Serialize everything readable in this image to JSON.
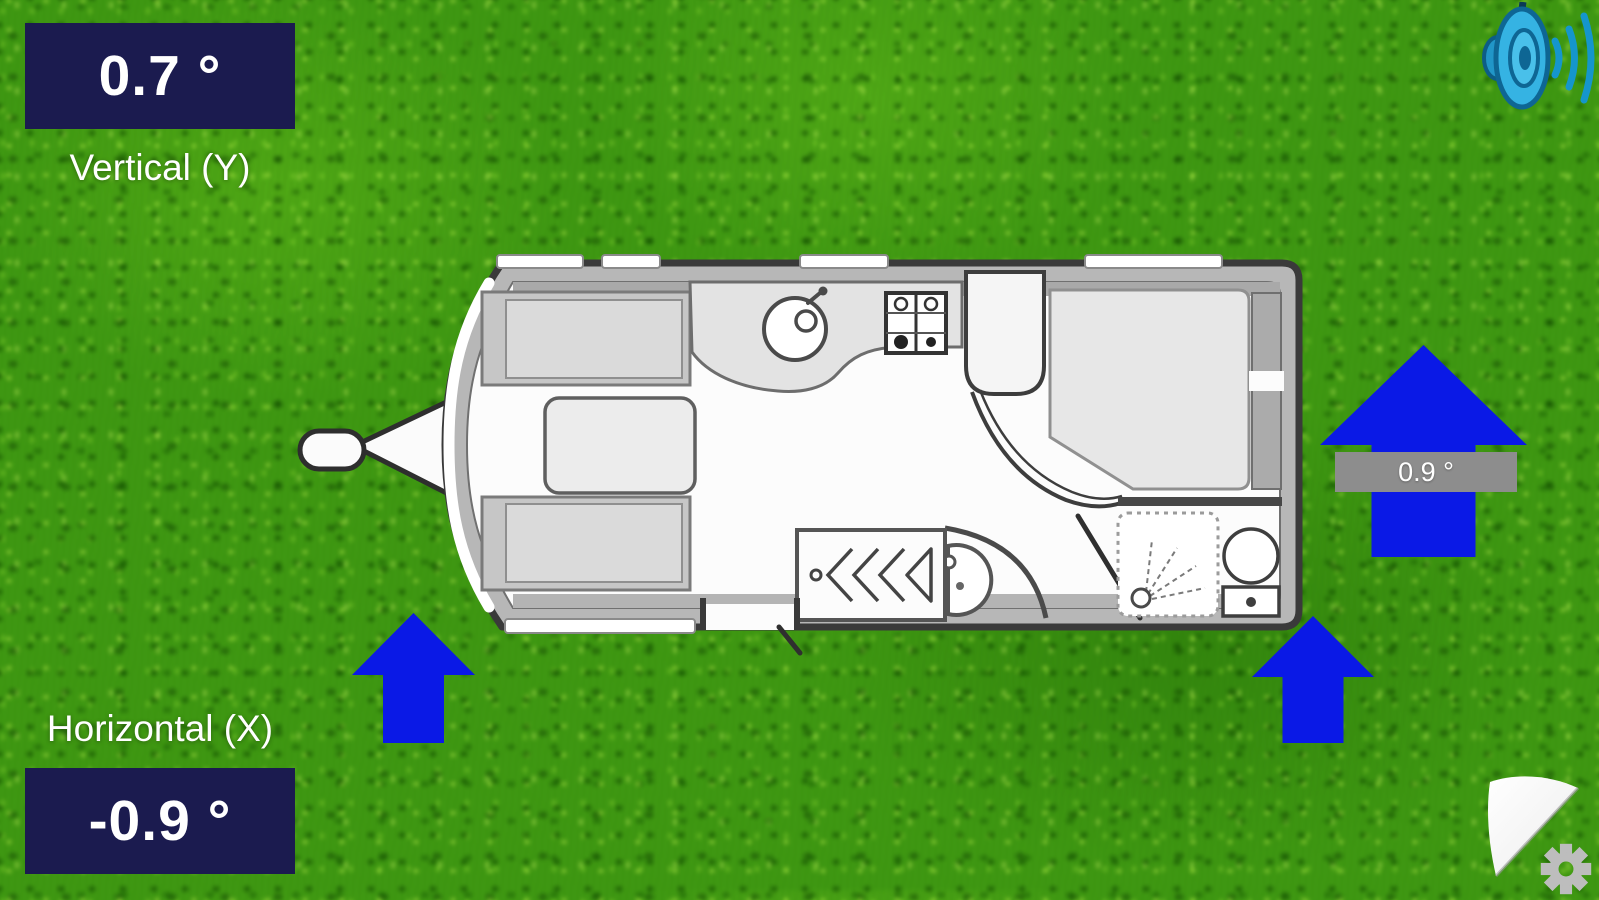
{
  "readouts": {
    "vertical": {
      "value": "0.7 °",
      "label": "Vertical (Y)"
    },
    "horizontal": {
      "value": "-0.9 °",
      "label": "Horizontal (X)"
    },
    "right_jockey": {
      "value": "0.9 °"
    }
  },
  "icons": {
    "sound": "speaker-with-sound-waves",
    "settings": "gear",
    "page_curl": "page-curl-corner"
  },
  "floorplan": {
    "type": "caravan-top-view",
    "fixtures": [
      "hitch",
      "front-lounge-benches",
      "table",
      "kitchen-sink",
      "hob",
      "wardrobe",
      "washbasin",
      "island-bed",
      "shower",
      "toilet",
      "entrance-door"
    ]
  },
  "colors": {
    "readout_bg": "#1b1b4f",
    "readout_text": "#ffffff",
    "label_text": "#ffffff",
    "arrow_blue": "#0a19e6",
    "arrow_label_bg": "#8d8d8d",
    "arrow_label_text": "#ffffff",
    "grass_base": "#46941f",
    "speaker_cyan": "#35b3e3",
    "gear_gray": "#bdbdbd"
  }
}
